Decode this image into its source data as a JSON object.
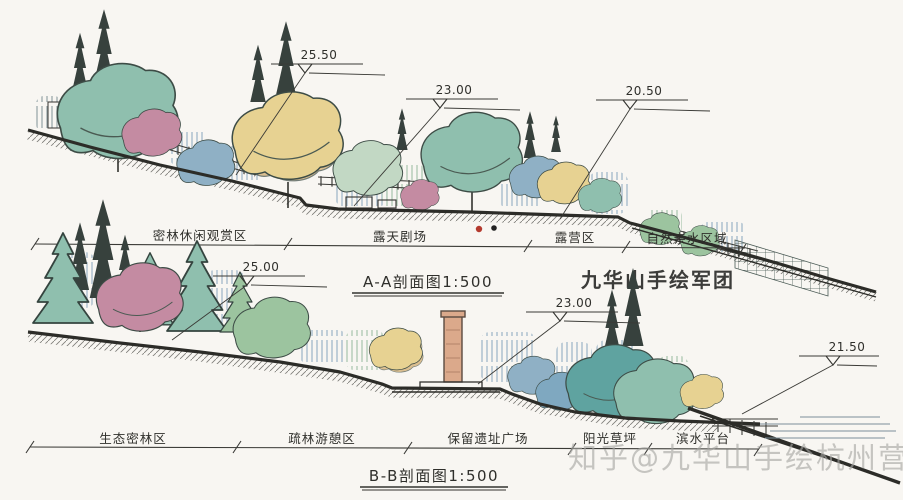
{
  "brand": "九华山手绘军团",
  "watermark": "知乎@九华山手绘杭州营",
  "palette": {
    "paper": "#f8f6f2",
    "ink": "#33332f",
    "tree_teal": "#8fbfae",
    "tree_yellow": "#e7d292",
    "tree_pink": "#c48ba2",
    "tree_blue": "#8fb0c5",
    "tree_green": "#9cc49f",
    "brick": "#dba98b",
    "red_dot": "#b43a2e",
    "black_dot": "#222222",
    "watermark_gray": "#a6a6a3"
  },
  "section_a": {
    "title": "A-A剖面图1:500",
    "elevations": [
      "25.50",
      "23.00",
      "20.50"
    ],
    "zones": [
      "密林休闲观赏区",
      "露天剧场",
      "露营区",
      "自然亲水区域"
    ]
  },
  "section_b": {
    "title": "B-B剖面图1:500",
    "elevations": [
      "25.00",
      "23.00",
      "21.50"
    ],
    "zones": [
      "生态密林区",
      "疏林游憩区",
      "保留遗址广场",
      "阳光草坪",
      "滨水平台"
    ]
  }
}
